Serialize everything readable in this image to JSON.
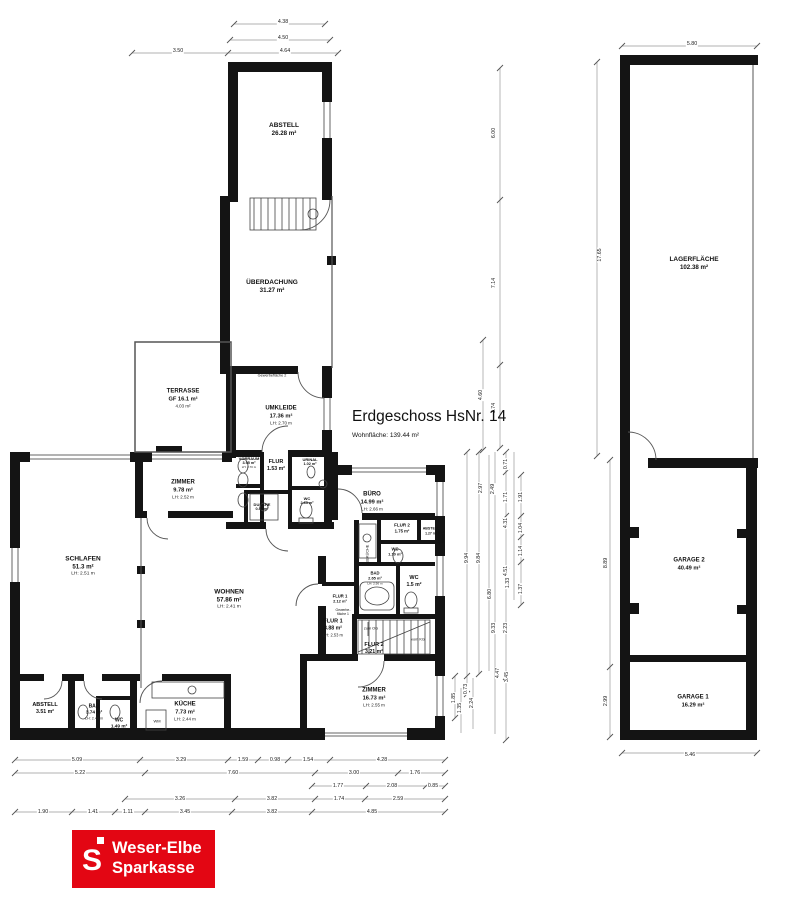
{
  "title": {
    "heading": "Erdgeschoss HsNr. 14",
    "subtitle": "Wohnfläche: 139.44 m²"
  },
  "logo": {
    "symbol": "S",
    "line1": "Weser-Elbe",
    "line2": "Sparkasse",
    "red": "#e30613"
  },
  "rooms": [
    {
      "name": "ABSTELL",
      "area": "26.28 m²",
      "x": 284,
      "y": 130,
      "s": 6.5
    },
    {
      "name": "ÜBERDACHUNG",
      "area": "31.27 m²",
      "x": 272,
      "y": 287,
      "s": 6.5
    },
    {
      "name": "TERRASSE",
      "area": "GF 16.1 m²",
      "lh": "4.03 m²",
      "x": 183,
      "y": 399,
      "s": 6
    },
    {
      "name": "UMKLEIDE",
      "area": "17.36 m²",
      "lh": "LH: 2.70 m",
      "x": 281,
      "y": 416,
      "s": 6
    },
    {
      "name": "ZIMMER",
      "area": "9.78 m²",
      "lh": "LH: 2.52 m",
      "x": 183,
      "y": 490,
      "s": 6
    },
    {
      "name": "VORRAUM",
      "area": "3.95 m²",
      "lh": "LH: 2.70 m",
      "x": 249,
      "y": 463,
      "s": 4
    },
    {
      "name": "FLUR",
      "area": "1.53 m²",
      "x": 276,
      "y": 466,
      "s": 5.5
    },
    {
      "name": "URINAL",
      "area": "1.02 m²",
      "x": 310,
      "y": 462,
      "s": 4
    },
    {
      "name": "DUSCHE",
      "area": "0.86 m²",
      "x": 262,
      "y": 507,
      "s": 4
    },
    {
      "name": "WC",
      "area": "2.63 m²",
      "x": 307,
      "y": 501,
      "s": 4
    },
    {
      "name": "BÜRO",
      "area": "14.99 m²",
      "lh": "LH: 2.66 m",
      "x": 372,
      "y": 502,
      "s": 6
    },
    {
      "name": "FLUR 2",
      "area": "1.75 m²",
      "x": 402,
      "y": 528,
      "s": 4.5
    },
    {
      "name": "ABSTELL",
      "area": "1.27 m²",
      "x": 431,
      "y": 531,
      "s": 3.6
    },
    {
      "name": "WC",
      "area": "1.10 m²",
      "x": 395,
      "y": 552,
      "s": 4.2
    },
    {
      "name": "SCHLAFEN",
      "area": "51.3 m²",
      "lh": "LH: 2.51 m",
      "x": 83,
      "y": 567,
      "s": 6.5
    },
    {
      "name": "WOHNEN",
      "area": "57.86 m²",
      "lh": "LH: 2.41 m",
      "x": 229,
      "y": 600,
      "s": 6.5
    },
    {
      "name": "BAD",
      "area": "2.65 m²",
      "lh": "LH: 2.56 m",
      "x": 375,
      "y": 578,
      "s": 4.2
    },
    {
      "name": "WC",
      "area": "1.5 m²",
      "x": 414,
      "y": 582,
      "s": 5.5
    },
    {
      "name": "FLUR 1",
      "area": "2.12 m²",
      "x": 340,
      "y": 599,
      "s": 4.2
    },
    {
      "name": "FLUR 1",
      "area": "3.88 m²",
      "lh": "LH: 2.53 m",
      "x": 333,
      "y": 628,
      "s": 5.5
    },
    {
      "name": "FLUR 2",
      "area": "3.21 m²",
      "x": 374,
      "y": 649,
      "s": 5.5
    },
    {
      "name": "ZIMMER",
      "area": "16.73 m²",
      "lh": "LH: 2.55 m",
      "x": 374,
      "y": 698,
      "s": 6
    },
    {
      "name": "ABSTELL",
      "area": "3.51 m²",
      "x": 45,
      "y": 709,
      "s": 5.5
    },
    {
      "name": "BAD",
      "area": "3.74 m²",
      "lh": "LH: 2.40 m",
      "x": 94,
      "y": 712,
      "s": 5
    },
    {
      "name": "WC",
      "area": "1.49 m²",
      "x": 119,
      "y": 724,
      "s": 5
    },
    {
      "name": "KÜCHE",
      "area": "7.73 m²",
      "lh": "LH: 2.44 m",
      "x": 185,
      "y": 712,
      "s": 6
    },
    {
      "name": "LAGERFLÄCHE",
      "area": "102.38 m²",
      "x": 694,
      "y": 264,
      "s": 6.5
    },
    {
      "name": "GARAGE 2",
      "area": "40.49 m²",
      "x": 689,
      "y": 565,
      "s": 6
    },
    {
      "name": "GARAGE 1",
      "area": "16.29 m²",
      "x": 693,
      "y": 702,
      "s": 6
    }
  ],
  "small_labels": [
    {
      "text": "Gewerbefläche 2",
      "x": 272,
      "y": 376,
      "s": 3.8
    },
    {
      "text": "Gewerbe-\nfläche 1",
      "x": 441,
      "y": 537,
      "s": 3.4,
      "rot": true
    },
    {
      "text": "Gewerbe-\nfläche 1",
      "x": 343,
      "y": 612,
      "s": 3.4
    },
    {
      "text": "TEEKÜCHE",
      "x": 368,
      "y": 555,
      "s": 3.8,
      "rot": true
    },
    {
      "text": "zum OG",
      "x": 371,
      "y": 629,
      "s": 3.8
    },
    {
      "text": "vom KG",
      "x": 418,
      "y": 640,
      "s": 3.8
    },
    {
      "text": "WM",
      "x": 157,
      "y": 722,
      "s": 4
    }
  ],
  "dimensions": [
    {
      "t": "4.38",
      "x": 283,
      "y": 22
    },
    {
      "t": "4.50",
      "x": 283,
      "y": 38
    },
    {
      "t": "3.50",
      "x": 178,
      "y": 51
    },
    {
      "t": "4.64",
      "x": 285,
      "y": 51
    },
    {
      "t": "6.00",
      "x": 494,
      "y": 133,
      "rot": true
    },
    {
      "t": "7.14",
      "x": 494,
      "y": 283,
      "rot": true
    },
    {
      "t": "4.60",
      "x": 481,
      "y": 395,
      "rot": true
    },
    {
      "t": "3.74",
      "x": 494,
      "y": 408,
      "rot": true
    },
    {
      "t": "0.71",
      "x": 506,
      "y": 464,
      "rot": true
    },
    {
      "t": "2.97",
      "x": 481,
      "y": 488,
      "rot": true
    },
    {
      "t": "2.49",
      "x": 493,
      "y": 489,
      "rot": true
    },
    {
      "t": "1.71",
      "x": 506,
      "y": 497,
      "rot": true
    },
    {
      "t": "1.91",
      "x": 521,
      "y": 497,
      "rot": true
    },
    {
      "t": "4.31",
      "x": 506,
      "y": 523,
      "rot": true
    },
    {
      "t": "1.04",
      "x": 521,
      "y": 528,
      "rot": true
    },
    {
      "t": "1.14",
      "x": 521,
      "y": 551,
      "rot": true
    },
    {
      "t": "9.94",
      "x": 467,
      "y": 558,
      "rot": true
    },
    {
      "t": "9.84",
      "x": 479,
      "y": 558,
      "rot": true
    },
    {
      "t": "4.51",
      "x": 506,
      "y": 571,
      "rot": true
    },
    {
      "t": "1.33",
      "x": 508,
      "y": 583,
      "rot": true
    },
    {
      "t": "1.37",
      "x": 521,
      "y": 589,
      "rot": true
    },
    {
      "t": "6.80",
      "x": 490,
      "y": 594,
      "rot": true
    },
    {
      "t": "9.33",
      "x": 494,
      "y": 628,
      "rot": true
    },
    {
      "t": "2.23",
      "x": 506,
      "y": 628,
      "rot": true
    },
    {
      "t": "4.47",
      "x": 498,
      "y": 673,
      "rot": true
    },
    {
      "t": "3.45",
      "x": 507,
      "y": 677,
      "rot": true
    },
    {
      "t": "0.73",
      "x": 466,
      "y": 689,
      "rot": true
    },
    {
      "t": "1.85",
      "x": 454,
      "y": 698,
      "rot": true
    },
    {
      "t": "2.24",
      "x": 472,
      "y": 703,
      "rot": true
    },
    {
      "t": "1.35",
      "x": 460,
      "y": 708,
      "rot": true
    },
    {
      "t": "5.80",
      "x": 692,
      "y": 44
    },
    {
      "t": "17.65",
      "x": 600,
      "y": 255,
      "rot": true
    },
    {
      "t": "8.89",
      "x": 606,
      "y": 563,
      "rot": true
    },
    {
      "t": "2.99",
      "x": 606,
      "y": 701,
      "rot": true
    },
    {
      "t": "5.46",
      "x": 690,
      "y": 755
    },
    {
      "t": "5.09",
      "x": 77,
      "y": 760
    },
    {
      "t": "3.29",
      "x": 181,
      "y": 760
    },
    {
      "t": "1.59",
      "x": 243,
      "y": 760
    },
    {
      "t": "0.98",
      "x": 275,
      "y": 760
    },
    {
      "t": "1.54",
      "x": 308,
      "y": 760
    },
    {
      "t": "4.28",
      "x": 382,
      "y": 760
    },
    {
      "t": "5.22",
      "x": 80,
      "y": 773
    },
    {
      "t": "7.60",
      "x": 233,
      "y": 773
    },
    {
      "t": "3.00",
      "x": 354,
      "y": 773
    },
    {
      "t": "1.76",
      "x": 415,
      "y": 773
    },
    {
      "t": "1.77",
      "x": 338,
      "y": 786
    },
    {
      "t": "2.08",
      "x": 392,
      "y": 786
    },
    {
      "t": "0.85",
      "x": 433,
      "y": 786
    },
    {
      "t": "3.26",
      "x": 180,
      "y": 799
    },
    {
      "t": "3.82",
      "x": 272,
      "y": 799
    },
    {
      "t": "1.74",
      "x": 339,
      "y": 799
    },
    {
      "t": "2.59",
      "x": 398,
      "y": 799
    },
    {
      "t": "1.90",
      "x": 43,
      "y": 812
    },
    {
      "t": "1.41",
      "x": 93,
      "y": 812
    },
    {
      "t": "1.11",
      "x": 128,
      "y": 812
    },
    {
      "t": "3.45",
      "x": 185,
      "y": 812
    },
    {
      "t": "3.82",
      "x": 272,
      "y": 812
    },
    {
      "t": "4.85",
      "x": 372,
      "y": 812
    }
  ]
}
